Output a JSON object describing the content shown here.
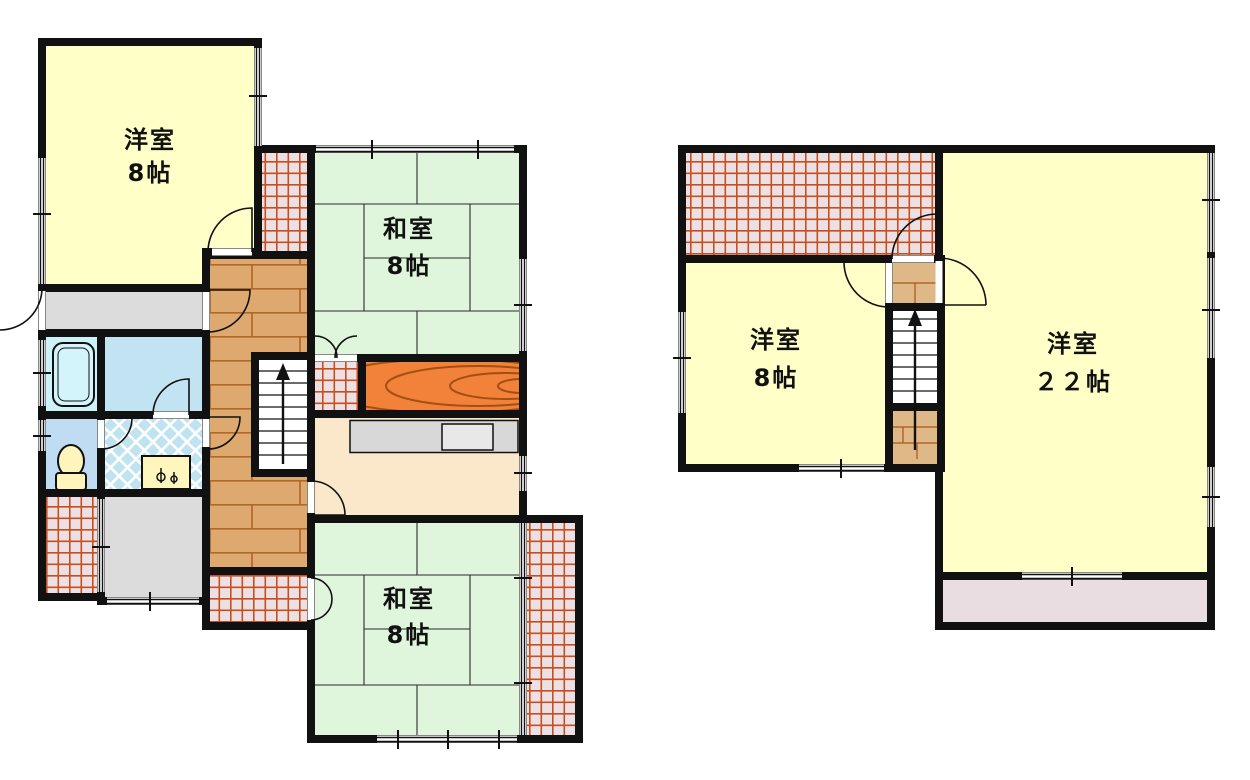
{
  "document": {
    "kind": "japanese-floor-plan"
  },
  "rooms": {
    "f1_western": {
      "name": "洋室",
      "size": "8帖"
    },
    "f1_japanese_north": {
      "name": "和室",
      "size": "8帖"
    },
    "f1_japanese_south": {
      "name": "和室",
      "size": "8帖"
    },
    "f2_western_small": {
      "name": "洋室",
      "size": "8帖"
    },
    "f2_western_large": {
      "name": "洋室",
      "size": "２２帖"
    }
  },
  "colors": {
    "wall": "#111111",
    "western_room": "#FFFFC8",
    "tatami_room": "#DFF5DC",
    "kitchen": "#FBE8CB",
    "closet_orange": "#F28239",
    "bath": "#CDF2F8",
    "changing": "#C2E4F2",
    "toilet_room": "#BFDCF2",
    "fixture_yellow": "#FFF4BC",
    "entrance_gray": "#DCDCDC",
    "balcony_grid_base": "#EDE0E4",
    "grid_line": "#C64F1E",
    "hallway_wood": "#DDA96E",
    "landing_wood": "#DFB887",
    "balcony_south": "#EADDE2"
  }
}
